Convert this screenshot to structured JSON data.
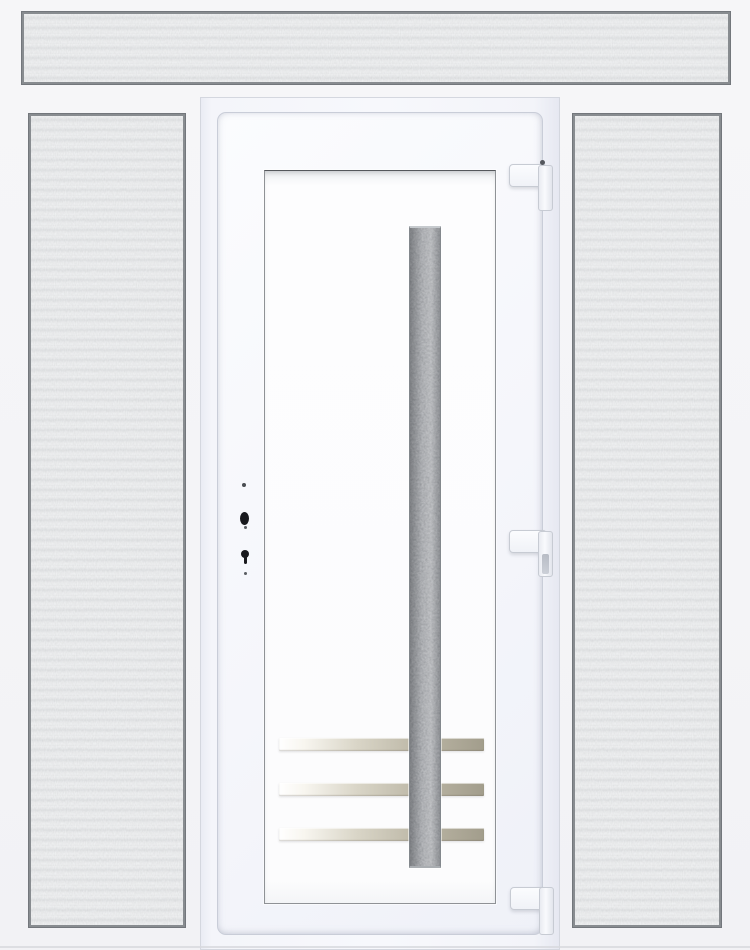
{
  "scene": {
    "subject": "white-upvc-entry-door-with-frosted-transom-and-two-frosted-sidelights",
    "transom": {
      "label": "transom-frosted-glass-panel"
    },
    "left_sidelight": {
      "label": "left-frosted-glass-side-panel"
    },
    "right_sidelight": {
      "label": "right-frosted-glass-side-panel"
    },
    "door": {
      "leaf": "white-door-leaf",
      "panel": "white-inset-door-panel",
      "glass_insert": "vertical-dark-speckled-glass-strip",
      "steel_strip_count": 3,
      "hinge_count": 3,
      "hinge_side": "right",
      "lock_hardware": [
        "screw-dot",
        "spindle-hole",
        "screw-dot",
        "keyhole",
        "screw-dot"
      ],
      "lock_side": "left"
    }
  },
  "colors": {
    "background": "#f6f6f8",
    "frame_white": "#f7f8fc",
    "leaf_white": "#f5f6fb",
    "panel_white": "#fdfdfe",
    "glass_frost": "#d3d5d7",
    "glass_border": "#888c90",
    "dark_glass": "#63686e",
    "steel_light": "#ffffff",
    "steel_dark": "#a29d8c",
    "hinge_white": "#f0f2f7",
    "hinge_border": "#c7cbd3",
    "hardware_black": "#191a1e"
  }
}
